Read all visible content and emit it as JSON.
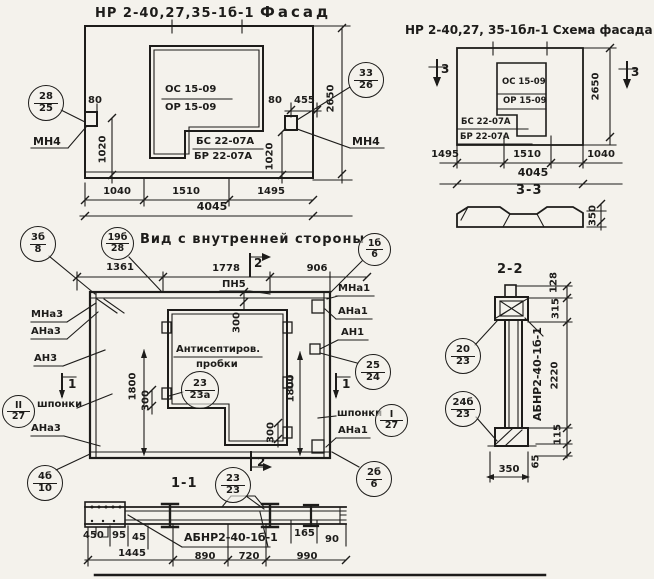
{
  "facade": {
    "title_code": "НР 2-40,27,35-1б-1",
    "title_name": "Фасад",
    "win_top": "ОС 15-09",
    "win_bot": "ОР 15-09",
    "sill_top": "БС 22-07А",
    "sill_bot": "БР 22-07А",
    "co_left_top": "28",
    "co_left_bot": "25",
    "co_right_top": "33",
    "co_right_bot": "26",
    "mn4_left": "МН4",
    "mn4_right": "МН4",
    "d80_left": "80",
    "d80_right": "80",
    "d455": "455",
    "d1020_left": "1020",
    "d1020_right": "1020",
    "d2650": "2650",
    "d1040": "1040",
    "d1510": "1510",
    "d1495": "1495",
    "d4045": "4045"
  },
  "schema": {
    "title_code": "НР 2-40,27, 35-1бл-1",
    "title_name": "Схема фасада",
    "win_top": "ОС 15-09",
    "win_bot": "ОР 15-09",
    "sill_top": "БС 22-07А",
    "sill_bot": "БР 22-07А",
    "sec_left": "3",
    "sec_right": "3",
    "d2650": "2650",
    "d1495": "1495",
    "d1510": "1510",
    "d1040": "1040",
    "d4045": "4045",
    "section_title": "3-3",
    "d350": "350"
  },
  "inner": {
    "title": "Вид с внутренней стороны",
    "co1_top": "3б",
    "co1_bot": "8",
    "co2_top": "19б",
    "co2_bot": "28",
    "co3_top": "1б",
    "co3_bot": "6",
    "d1361": "1361",
    "d1778": "1778",
    "d906": "906",
    "pn5": "ПН5",
    "sec2_top": "2",
    "sec2_bot": "2",
    "sec1_left": "1",
    "sec1_right": "1",
    "mna3": "МНа3",
    "ana3_top": "АНа3",
    "an3": "АН3",
    "shponki_left": "шпонки",
    "co_ii_top": "II",
    "co_ii_bot": "27",
    "ana3_bot": "АНа3",
    "mna1": "МНа1",
    "ana1_top": "АНа1",
    "an1": "АН1",
    "co_2524_top": "25",
    "co_2524_bot": "24",
    "shponki_right": "шпонки",
    "co_i_top": "I",
    "co_i_bot": "27",
    "ana1_bot": "АНа1",
    "note1": "Антисептиров.",
    "note2": "пробки",
    "co_note_top": "23",
    "co_note_bot": "23а",
    "d1800_left": "1800",
    "d1800_right": "1800",
    "d300_top": "300",
    "d300_left": "300",
    "d300_right": "300",
    "co_bl_top": "4б",
    "co_bl_bot": "10",
    "co_br_top": "2б",
    "co_br_bot": "6",
    "co_bc_top": "23",
    "co_bc_bot": "23"
  },
  "sec11": {
    "title": "1-1",
    "mark": "АБНР2-40-1б-1",
    "d450": "450",
    "d95": "95",
    "d45": "45",
    "d165": "165",
    "d90": "90",
    "d1445": "1445",
    "d890": "890",
    "d720": "720",
    "d990": "990"
  },
  "sec22": {
    "title": "2-2",
    "mark": "АБНР2-40-1б-1",
    "d128": "128",
    "d315": "315",
    "d2220": "2220",
    "d115": "115",
    "d65": "65",
    "d350": "350",
    "co_top_top": "20",
    "co_top_bot": "23",
    "co_bot_top": "24б",
    "co_bot_bot": "23"
  }
}
